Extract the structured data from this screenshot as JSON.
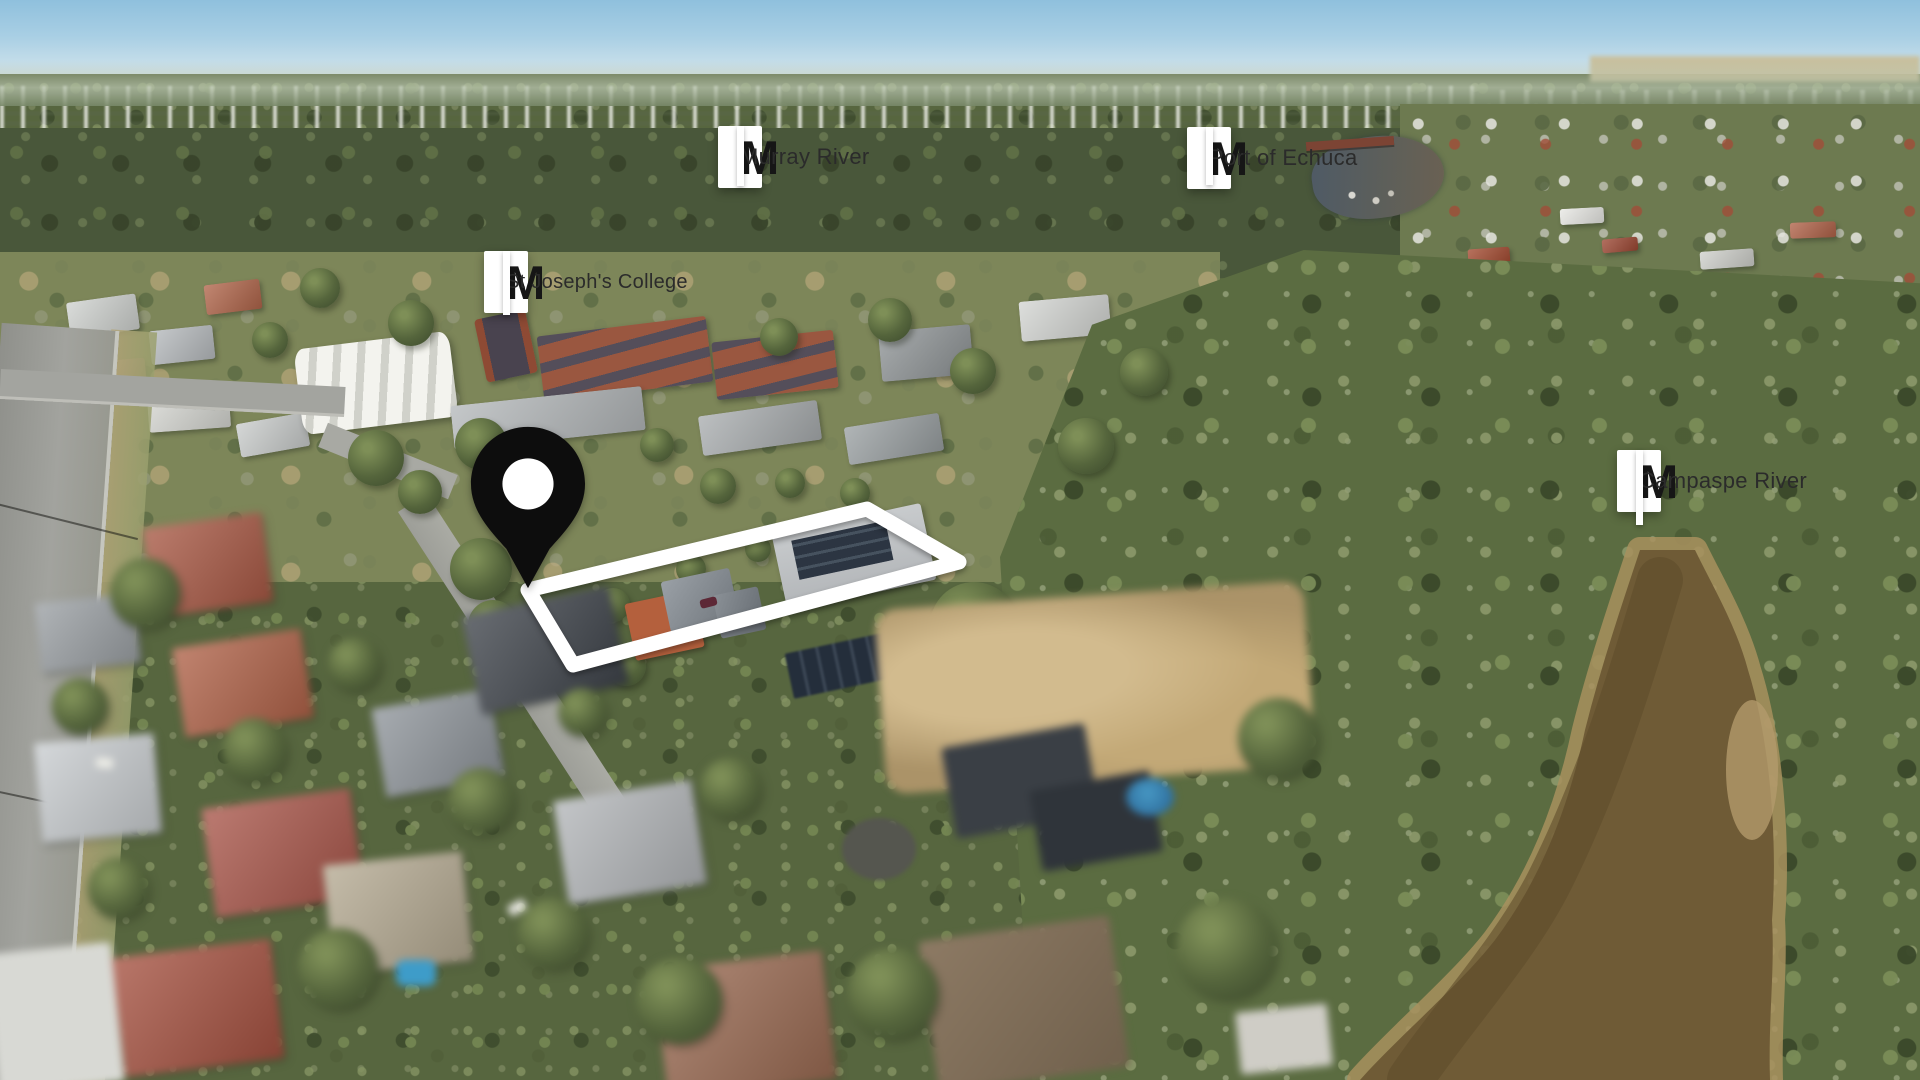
{
  "map_overlay": {
    "logo_letter": "M",
    "labels": [
      {
        "id": "murray-river",
        "text": "Murray River"
      },
      {
        "id": "port-of-echuca",
        "text": "Port of Echuca"
      },
      {
        "id": "st-josephs-college",
        "text": "St Joseph's College"
      },
      {
        "id": "campaspe-river",
        "text": "Campaspe River"
      }
    ],
    "colors": {
      "label_background": "#ffffff",
      "label_text": "#2b2b2b",
      "logo": "#161616",
      "pointer_line": "#ffffff",
      "location_pin": "#0d0d0d",
      "property_boundary": "#ffffff"
    }
  }
}
